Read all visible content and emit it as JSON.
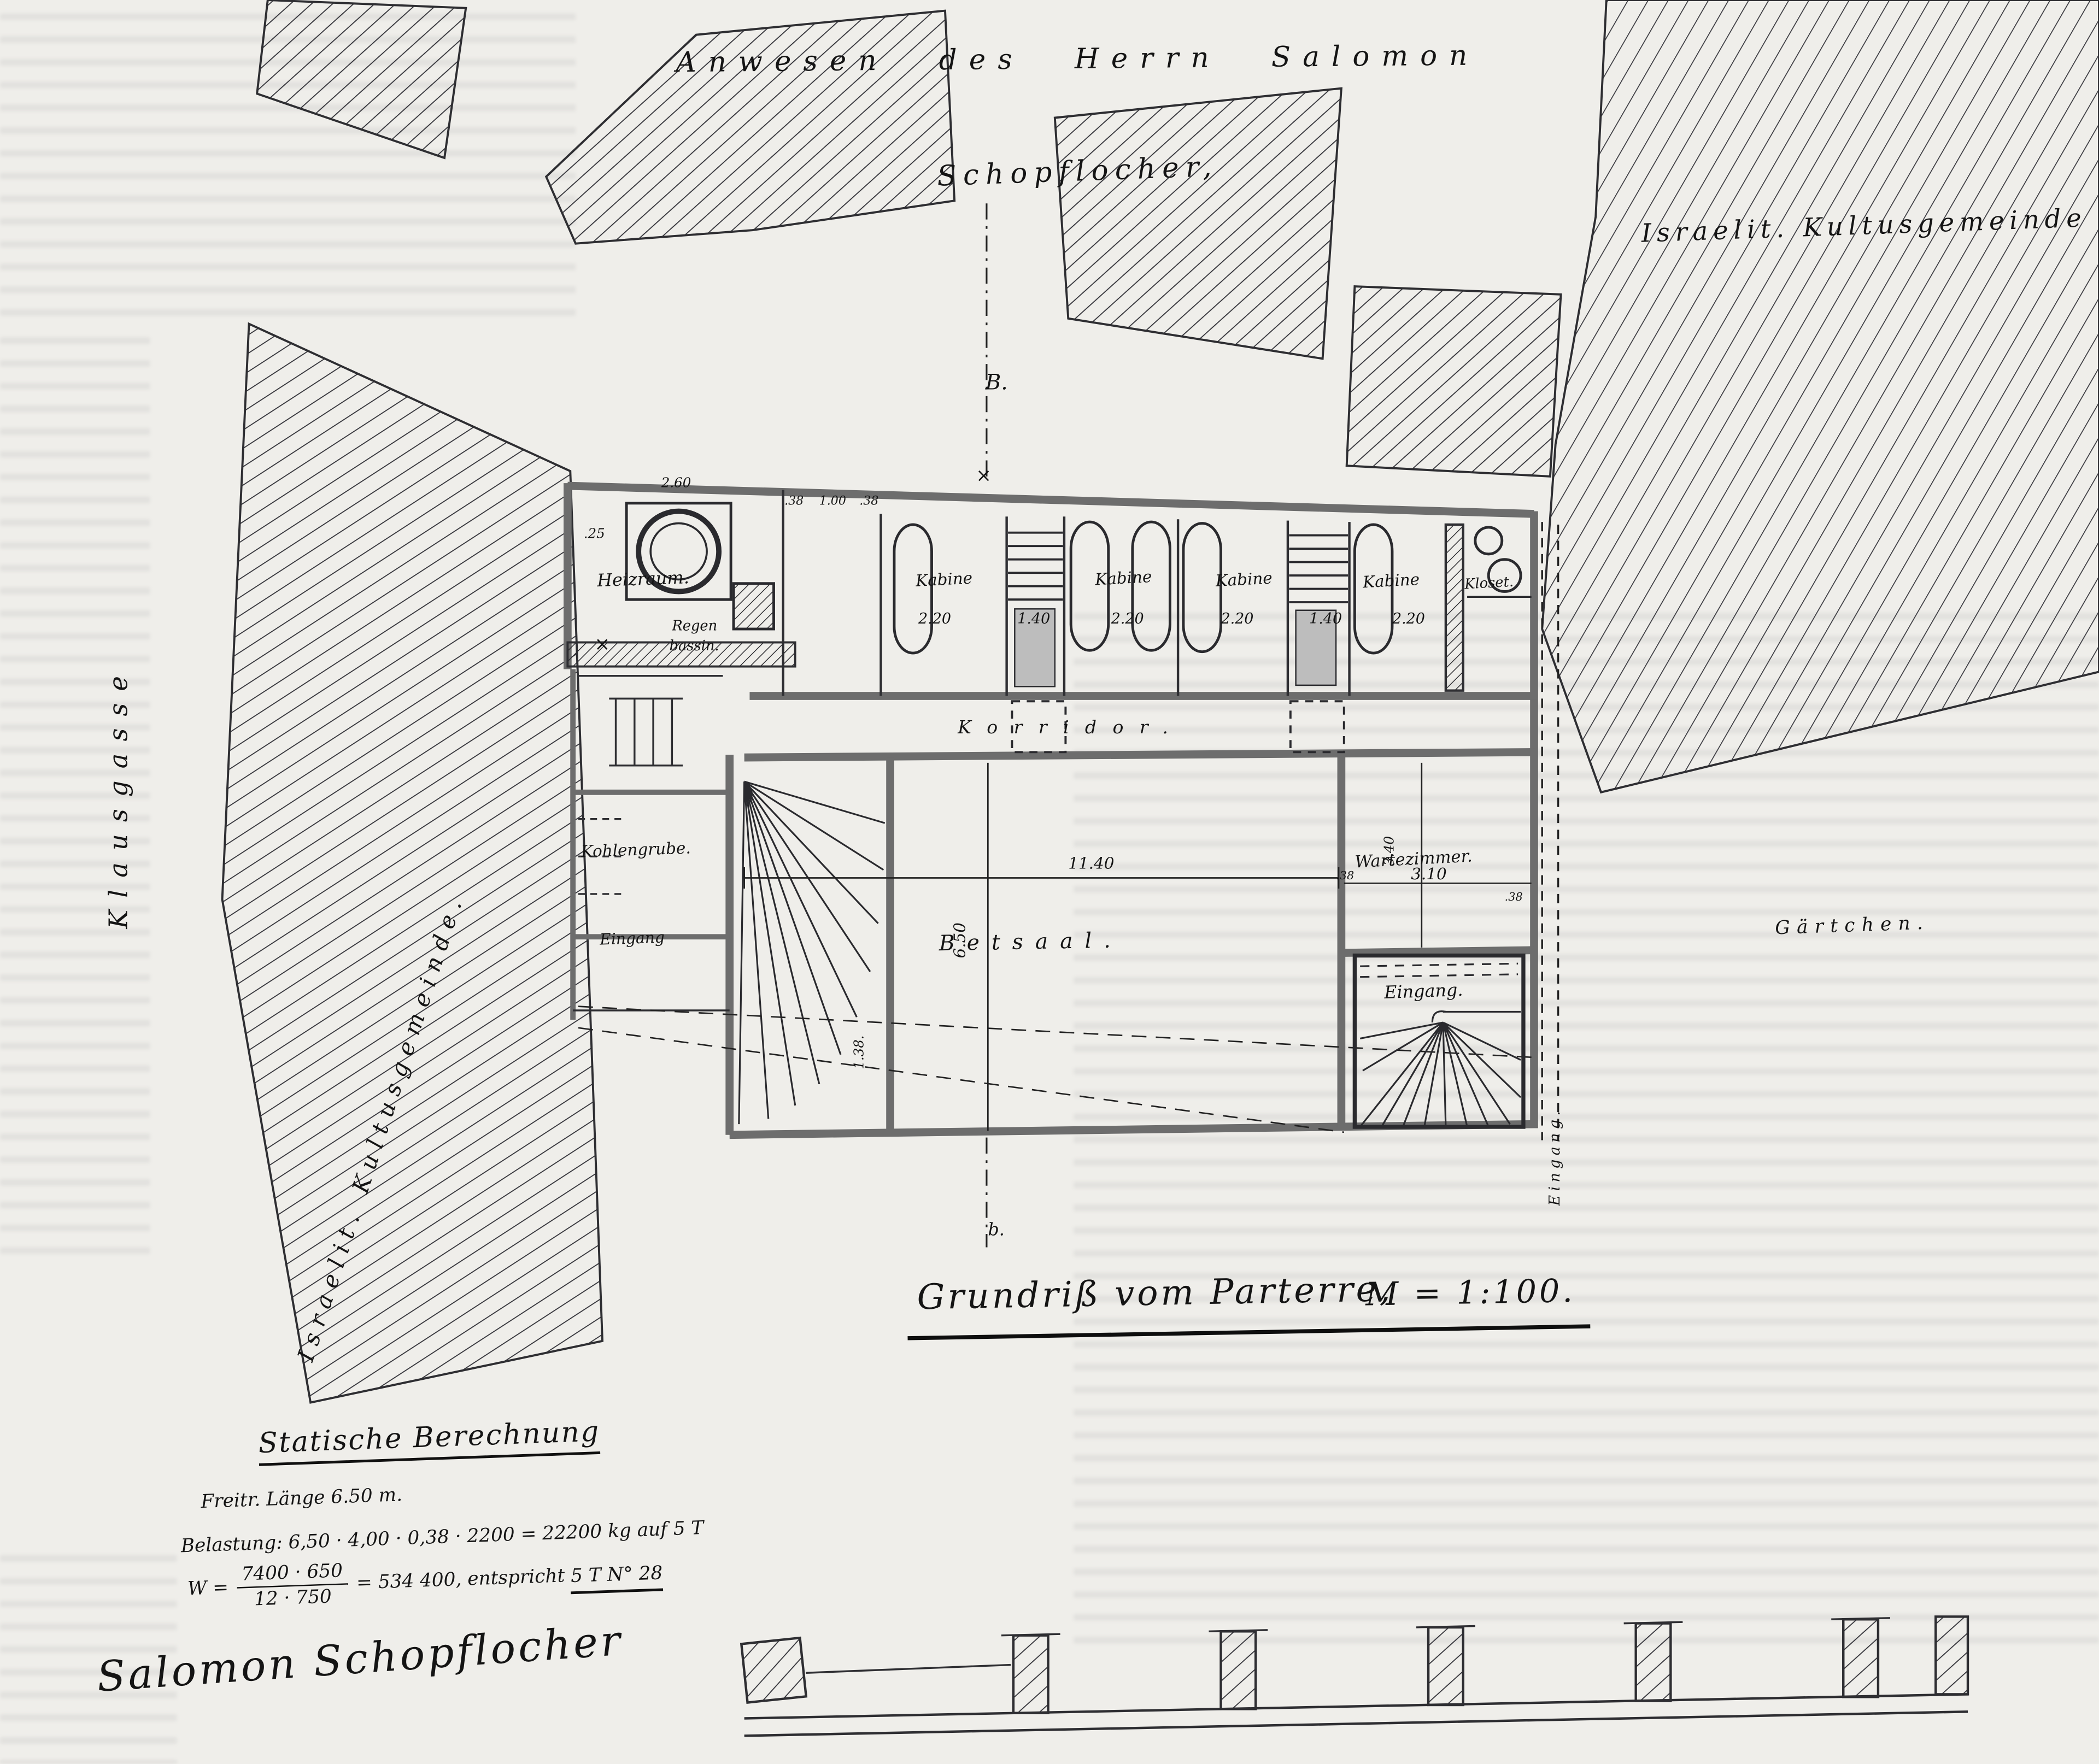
{
  "site": {
    "estate": "Anwesen des Herrn Salomon",
    "schopflocher": "Schopflocher,",
    "kultusgemeinde_right": "Israelit. Kultusgemeinde",
    "kultusgemeinde_left": "Israelit. Kultusgemeinde.",
    "klausgasse": "Klausgasse",
    "gaertchen": "Gärtchen."
  },
  "rooms": {
    "heizraum": "Heizraum.",
    "regen": "Regen",
    "bassin": "bassin.",
    "kabine": "Kabine",
    "kloset": "Kloset.",
    "korridor": "Korridor.",
    "kohlengrube": "Kohlengrube.",
    "eingang_left": "Eingang",
    "betsaal": "Betsaal.",
    "wartezimmer": "Wartezimmer.",
    "eingang_stair": "Eingang.",
    "eingang_side": "Eingang."
  },
  "dimensions": {
    "d_25": ".25",
    "d_260": "2.60",
    "d_38a": ".38",
    "d_100": "1.00",
    "d_38b": ".38",
    "k1": "2.20",
    "k2": "1.40",
    "k3": "2.20",
    "k4": "2.20",
    "k5": "1.40",
    "k6": "2.20",
    "hall_w": "11.40",
    "hall_h": "6.50",
    "d_138": "1.38.",
    "wz_w": "3.10",
    "wz_h": "3.40",
    "wz_38a": ".38",
    "wz_38b": ".38"
  },
  "markers": {
    "sec_top": "B.",
    "sec_bottom": "b.",
    "x": "×"
  },
  "title": {
    "main": "Grundriß vom Parterre,",
    "scale": "M = 1:100."
  },
  "statics": {
    "heading": "Statische Berechnung",
    "line1": "Freitr. Länge 6.50 m.",
    "line2": "Belastung: 6,50 · 4,00 · 0,38 · 2200 = 22200 kg auf 5 T",
    "line3_lead": "W =",
    "line3_num": "7400 · 650",
    "line3_den": "12 · 750",
    "line3_mid": "= 534 400, entspricht",
    "line3_end": "5 T N° 28"
  },
  "signature": "Salomon Schopflocher",
  "colors": {
    "ink": "#1e1e1e",
    "wall": "#6d6d6d",
    "paper": "#efeeea"
  }
}
